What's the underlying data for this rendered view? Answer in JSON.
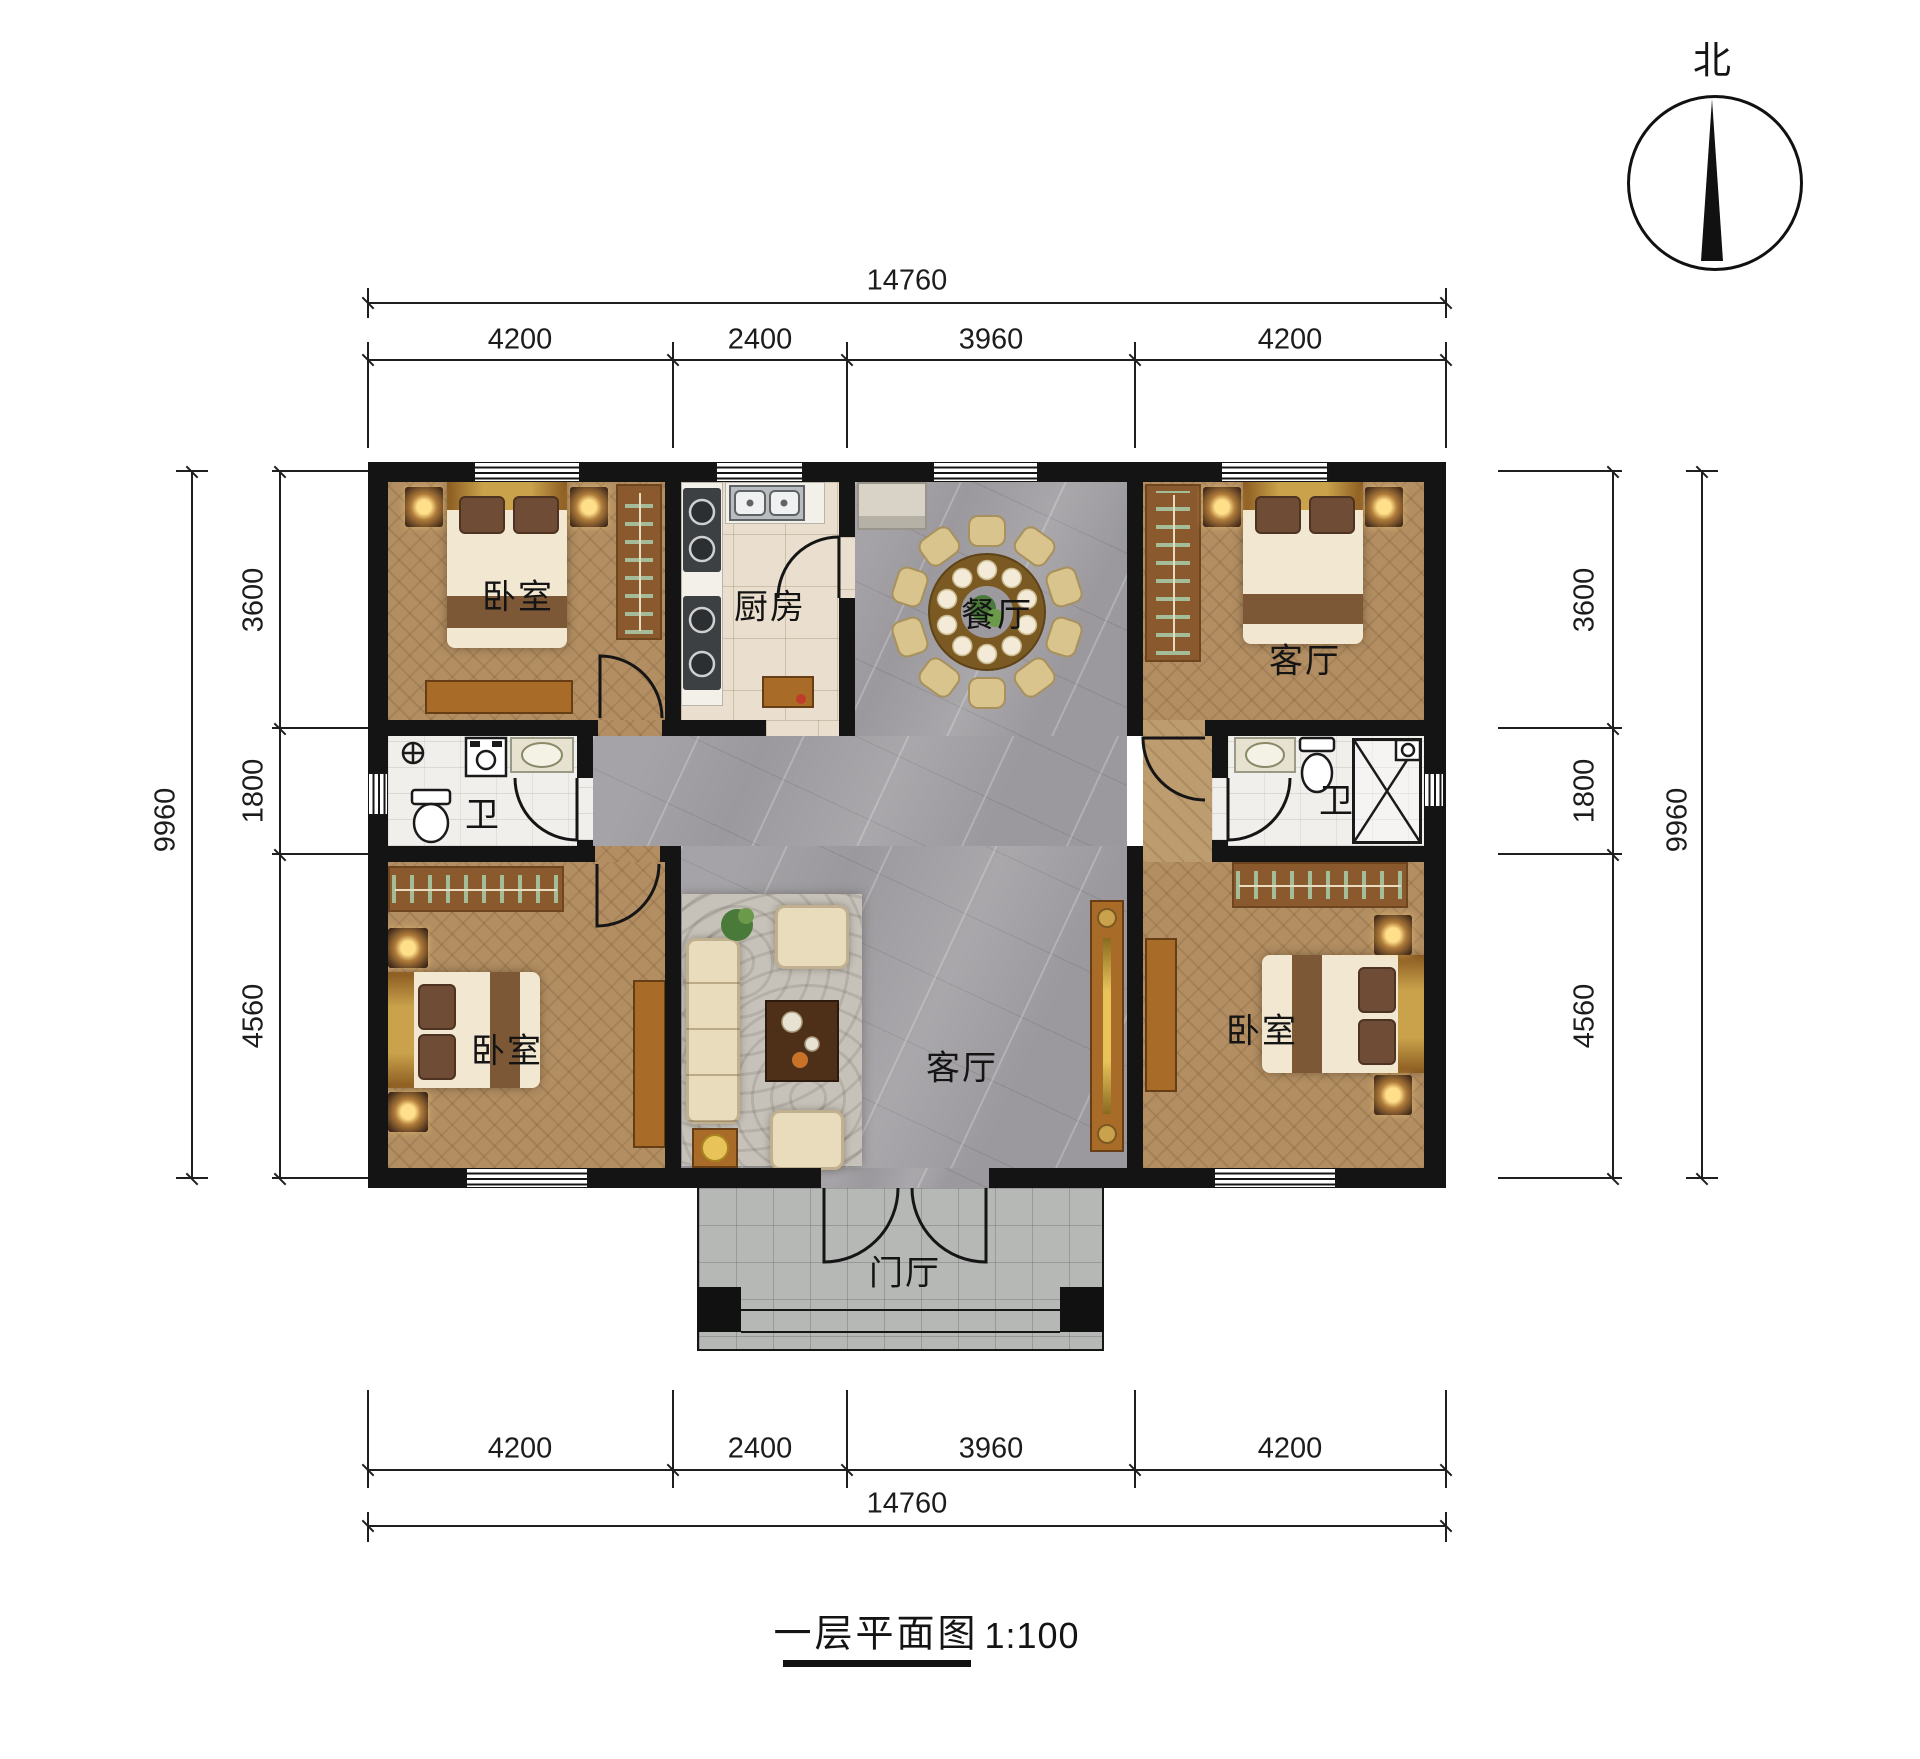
{
  "title_block": {
    "title": "一层平面图",
    "scale": "1:100"
  },
  "compass": {
    "north_label": "北"
  },
  "rooms": {
    "bedroom_top_left": {
      "label": "卧室"
    },
    "kitchen": {
      "label": "厨房"
    },
    "dining": {
      "label": "餐厅"
    },
    "living_top_right": {
      "label": "客厅"
    },
    "bath_left": {
      "label": "卫"
    },
    "bath_right": {
      "label": "卫"
    },
    "bedroom_bottom_left": {
      "label": "卧室"
    },
    "living_center": {
      "label": "客厅"
    },
    "bedroom_bottom_right": {
      "label": "卧室"
    },
    "foyer": {
      "label": "门厅"
    }
  },
  "dimensions": {
    "top": {
      "total": "14760",
      "segments": [
        "4200",
        "2400",
        "3960",
        "4200"
      ]
    },
    "bottom": {
      "total": "14760",
      "segments": [
        "4200",
        "2400",
        "3960",
        "4200"
      ]
    },
    "left": {
      "total": "9960",
      "segments": [
        "3600",
        "1800",
        "4560"
      ]
    },
    "right": {
      "total": "9960",
      "segments": [
        "3600",
        "1800",
        "4560"
      ]
    }
  },
  "colors": {
    "wall": "#141414",
    "wood": "#b28e62",
    "wood_light": "#bd9c6f",
    "marble": "#9b999d",
    "tile": "#eadfce",
    "bath": "#f0efec",
    "porch": "#b6b8b6",
    "bed_cream": "#f2e8d2",
    "bed_band": "#7d5836",
    "pillow": "#6f4c35",
    "headboard_gold": "#c9a24b",
    "furniture_brown": "#8a5a2e",
    "console": "#a96c28",
    "sofa": "#e9dcbc",
    "rug": "#c6c2ba",
    "table_brown": "#7a5a22",
    "chair": "#d8c48c"
  }
}
